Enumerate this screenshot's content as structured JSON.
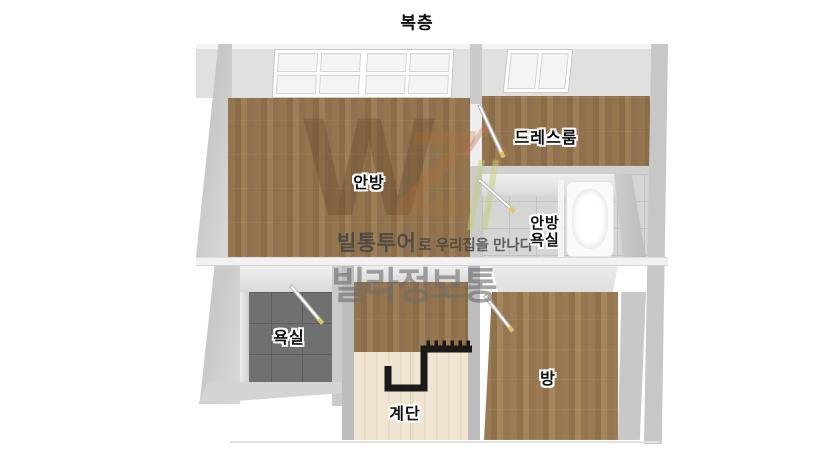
{
  "title": "복층",
  "rooms": {
    "anbang": {
      "label": "안방"
    },
    "dressroom": {
      "label": "드레스룸"
    },
    "anbang_bathroom": {
      "label_line1": "안방",
      "label_line2": "욕실"
    },
    "bathroom": {
      "label": "욕실"
    },
    "stairs": {
      "label": "계단"
    },
    "room": {
      "label": "방"
    }
  },
  "watermark": {
    "logo_letter_1": "W",
    "logo_letter_2": "Z",
    "brand": "빌통투어",
    "tagline": "로 우리집을 만나다",
    "brand_large": "빌라정보통"
  },
  "colors": {
    "wall": "#c7c7c7",
    "wall_face": "#e3e3e3",
    "wood": "#8f7350",
    "wood_light_floor": "#eee3d0",
    "tile_dark": "#707070",
    "tile_light": "#d5d5d3",
    "railing": "#1a1a1a",
    "door_handle": "#e6c54d"
  }
}
